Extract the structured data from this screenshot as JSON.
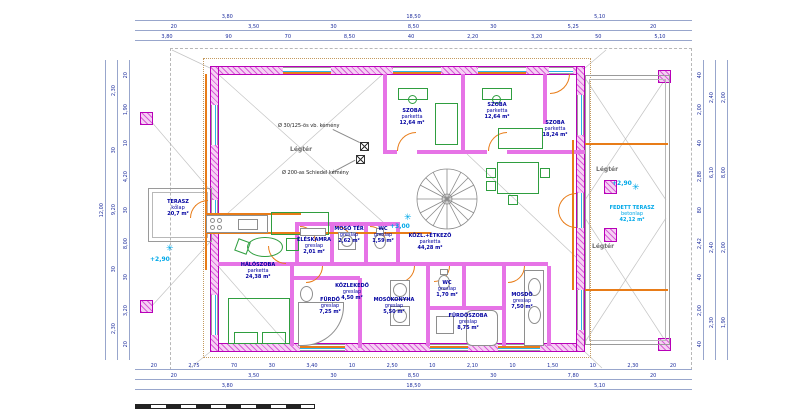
{
  "rooms": {
    "terasz_left": {
      "name": "TERASZ",
      "floor": "kőlap",
      "area": "20,7 m²"
    },
    "haloszoba": {
      "name": "HÁLÓSZOBA",
      "floor": "parketta",
      "area": "24,38 m²"
    },
    "szoba1": {
      "name": "SZOBA",
      "floor": "parketta",
      "area": "12,64 m²"
    },
    "szoba2": {
      "name": "SZOBA",
      "floor": "parketta",
      "area": "12,64 m²"
    },
    "szoba3": {
      "name": "SZOBA",
      "floor": "parketta",
      "area": "18,24 m²"
    },
    "eleskamra": {
      "name": "ÉLÉSKAMRA",
      "floor": "greslap",
      "area": "2,01 m²"
    },
    "mosoter": {
      "name": "MOSÓ TÉR",
      "floor": "greslap",
      "area": "2,62 m²"
    },
    "wc1": {
      "name": "WC",
      "floor": "greslap",
      "area": "1,59 m²"
    },
    "etkezo": {
      "name": "KÖZL.+ÉTKEZŐ",
      "floor": "parketta",
      "area": "44,28 m²"
    },
    "kozlekedo": {
      "name": "KÖZLEKEDŐ",
      "floor": "greslap",
      "area": "4,50 m²"
    },
    "furdo": {
      "name": "FÜRDŐ",
      "floor": "greslap",
      "area": "7,25 m²"
    },
    "mosokonyha": {
      "name": "MOSÓKONYHA",
      "floor": "greslap",
      "area": "5,50 m²"
    },
    "wc2": {
      "name": "WC",
      "floor": "greslap",
      "area": "1,70 m²"
    },
    "furdoszoba": {
      "name": "FÜRDŐSZOBA",
      "floor": "greslap",
      "area": "8,75 m²"
    },
    "mosdo": {
      "name": "MOSDÓ",
      "floor": "greslap",
      "area": "7,50 m²"
    },
    "fedett_terasz": {
      "name": "FEDETT TERASZ",
      "floor": "betonlap",
      "area": "42,12 m²"
    }
  },
  "annotations": {
    "chimney1": "Ø 30/125-ös vb. kémény",
    "chimney2": "Ø 200-as Schiedel kémény",
    "legter": "Légtér",
    "level_left": "+2,90",
    "level_main": "+3,00",
    "level_right": "+2,90",
    "star": "✳"
  },
  "dims": {
    "top_row1": [
      "3,80",
      "18,50",
      "5,10"
    ],
    "top_row2": [
      "20",
      "3,50",
      "30",
      "8,50",
      "30",
      "5,25",
      "20"
    ],
    "top_row3": [
      "3,80",
      "90",
      "70",
      "8,50",
      "40",
      "2,20",
      "3,20",
      "50",
      "5,10"
    ],
    "bottom_row1": [
      "20",
      "2,75",
      "70",
      "30",
      "3,40",
      "10",
      "2,50",
      "10",
      "2,10",
      "10",
      "1,50",
      "10",
      "2,30",
      "20"
    ],
    "bottom_row2": [
      "20",
      "3,50",
      "30",
      "8,50",
      "30",
      "7,80",
      "20"
    ],
    "bottom_row3": [
      "3,80",
      "18,50",
      "5,10"
    ],
    "left_col1": [
      "12,00"
    ],
    "left_col2": [
      "2,30",
      "30",
      "9,20",
      "30",
      "2,30"
    ],
    "left_col3": [
      "20",
      "1,90",
      "10",
      "4,20",
      "30",
      "8,00",
      "30",
      "3,20",
      "20"
    ],
    "right_col1": [
      "40",
      "2,00",
      "40",
      "2,88",
      "80",
      "2,42",
      "40",
      "2,00",
      "40"
    ],
    "right_col2": [
      "2,40",
      "6,10",
      "2,40",
      "2,30"
    ],
    "right_col3": [
      "2,00",
      "8,00",
      "2,00",
      "1,90"
    ]
  }
}
